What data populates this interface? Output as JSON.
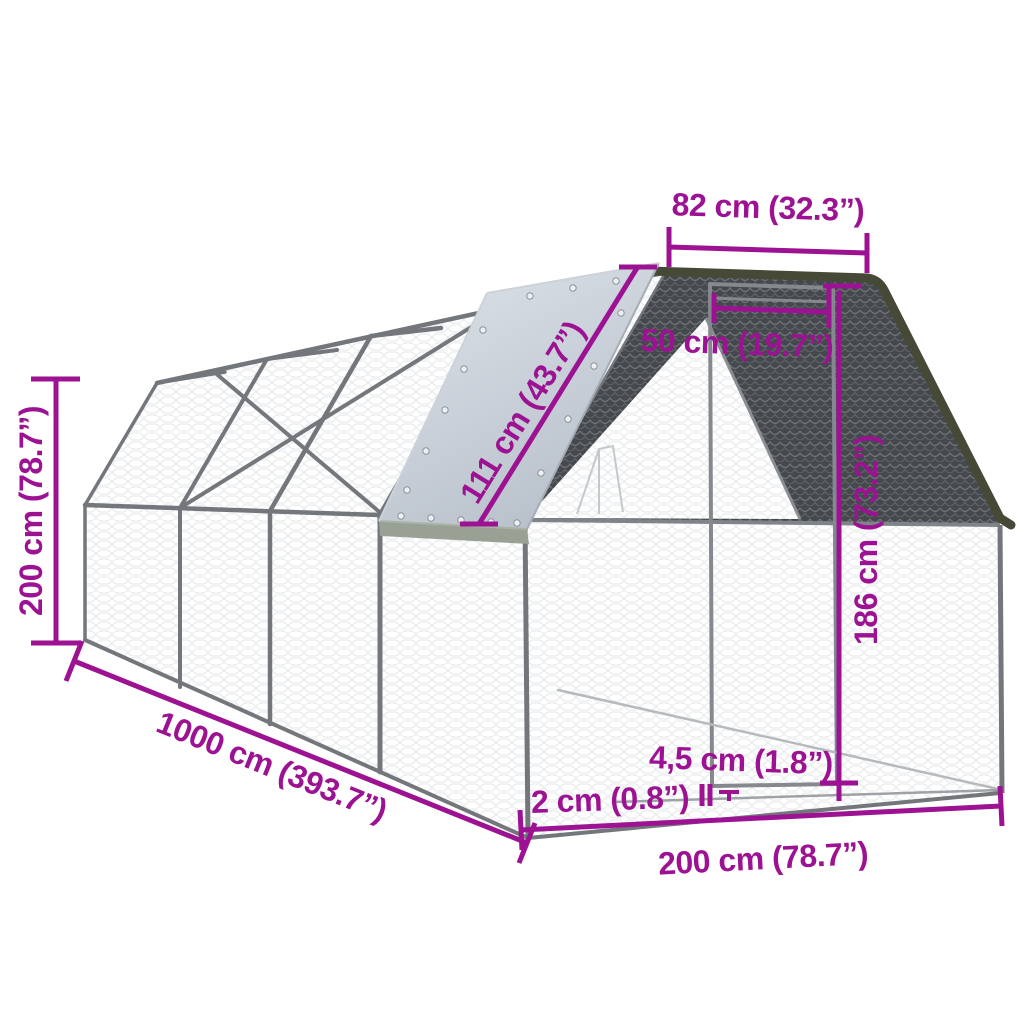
{
  "diagram": {
    "type": "product-dimension-diagram",
    "subject": "outdoor walk-in chicken run cage with mesh walls, dark mesh gable end, door and roof tarp",
    "accent_color": "#9D1292",
    "dimensions": {
      "height": "200 cm (78.7”)",
      "length": "1000 cm (393.7”)",
      "width": "200 cm (78.7”)",
      "roof_top_width": "82 cm (32.3”)",
      "door_width": "50 cm (19.7”)",
      "roof_cover_slope": "111 cm (43.7”)",
      "door_height": "186 cm (73.2”)",
      "frame_tube": "4,5 cm (1.8”)",
      "ground_clearance": "2 cm (0.8”)"
    },
    "colors": {
      "dimension_text": "#9D1292",
      "frame": "#73777C",
      "dark_mesh": "#45484C",
      "tarp": "#C8CFD8",
      "tarp_edge_strip": "#98A194",
      "gable_trim": "#474937",
      "background": "#FFFFFF"
    }
  }
}
